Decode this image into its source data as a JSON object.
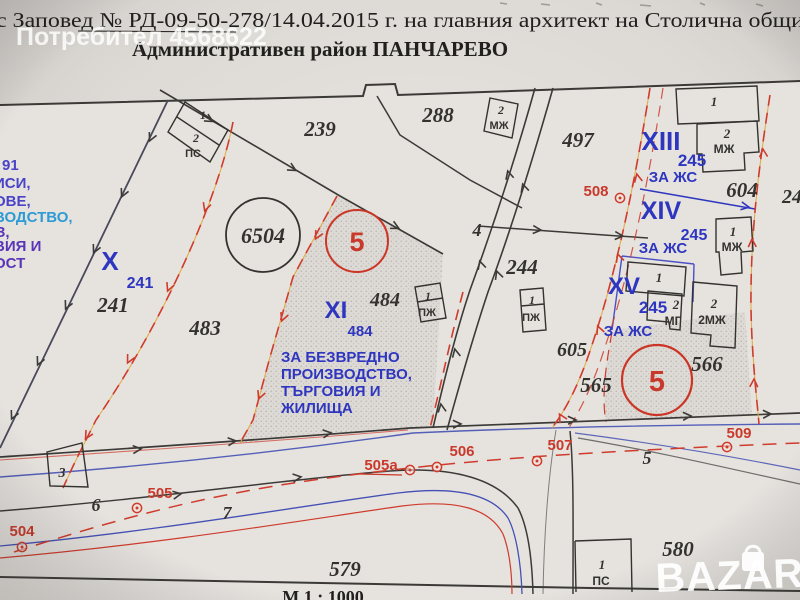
{
  "header": {
    "order_line": "с Заповед № РД-09-50-278/14.04.2015 г. на главния архитект на Столична общи",
    "district_line": "Административен район ПАНЧАРЕВО"
  },
  "watermarks": {
    "user": "Потребител 4568622",
    "site_logo": "BAZAR"
  },
  "left_margin_fragments": {
    "l1": "91",
    "l2": "ИСИ,",
    "l3": "ОВЕ,",
    "l4": "ВОДСТВО,",
    "l5": "З,",
    "l6": "ВИЯ И",
    "l7": "ОСТ"
  },
  "map": {
    "scale": "М 1 : 1000",
    "parcel_numbers": {
      "p239": "239",
      "p288": "288",
      "p497": "497",
      "p241": "241",
      "p241r": "241",
      "p483": "483",
      "p6504": "6504",
      "p484": "484",
      "p484r": "484",
      "p244": "244",
      "p604": "604",
      "p604cut": "24",
      "p566": "566",
      "p565": "565",
      "p605": "605",
      "p579": "579",
      "p580": "580"
    },
    "road_numbers": {
      "r4": "4",
      "r5": "5",
      "r6": "6",
      "r7": "7"
    },
    "regulation_units": {
      "uX": "X",
      "uXI": "XI",
      "uXIII": "XIII",
      "uXIV": "XIV",
      "uXV": "XV",
      "reg245": "245",
      "zhs": "ЗА ЖС",
      "circle5": "5"
    },
    "zone_text": {
      "z1": "ЗА БЕЗВРЕДНО",
      "z2": "ПРОИЗВОДСТВО,",
      "z3": "ТЪРГОВИЯ И",
      "z4": "ЖИЛИЩА"
    },
    "survey_points": {
      "s504": "504",
      "s505": "505",
      "s505a": "505а",
      "s506": "506",
      "s507": "507",
      "s508": "508",
      "s509": "509"
    },
    "building_labels": {
      "n1": "1",
      "n2": "2",
      "n3": "3",
      "ps": "ПС",
      "mzh": "МЖ",
      "pzh": "ПЖ",
      "mg": "МГ",
      "m2zh": "2МЖ"
    }
  }
}
